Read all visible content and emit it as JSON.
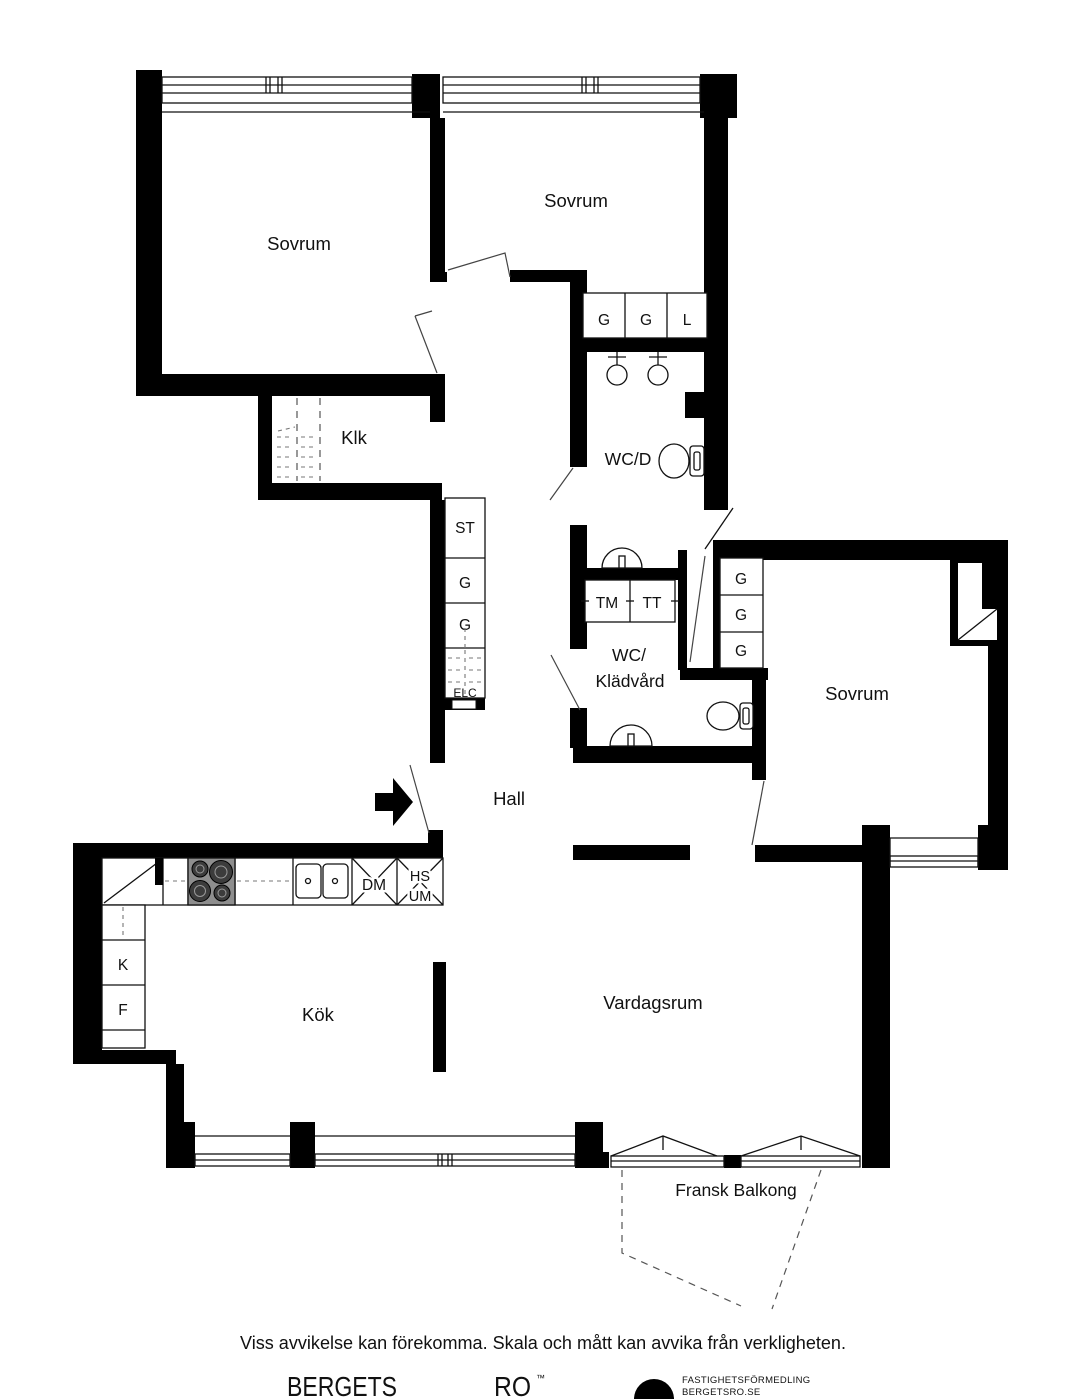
{
  "plan": {
    "rooms": {
      "bedroom": "Sovrum",
      "closet": "Klk",
      "wc_shower": "WC/D",
      "wc_laundry": [
        "WC/",
        "Klädvård"
      ],
      "hall": "Hall",
      "kitchen": "Kök",
      "living_room": "Vardagsrum",
      "french_balcony": "Fransk Balkong"
    },
    "cabinet_codes": {
      "wardrobe": "G",
      "linen": "L",
      "cleaning": "ST",
      "electrical": "ELC"
    },
    "appliance_codes": {
      "washing_machine": "TM",
      "tumble_dryer": "TT",
      "dishwasher": "DM",
      "fridge": "K",
      "freezer": "F",
      "tall_unit_top": "HS",
      "tall_unit_bottom": "UM"
    },
    "colors": {
      "wall": "#000000",
      "background": "#ffffff",
      "stove": "#8e8e8e"
    }
  },
  "footer": {
    "disclaimer": "Viss avvikelse kan förekomma. Skala och mått kan avvika från verkligheten.",
    "brand_name_1": "BERGETS",
    "brand_name_2": "RO",
    "trademark": "™",
    "agency_line1": "FASTIGHETSFÖRMEDLING",
    "agency_line2": "BERGETSRO.SE"
  }
}
